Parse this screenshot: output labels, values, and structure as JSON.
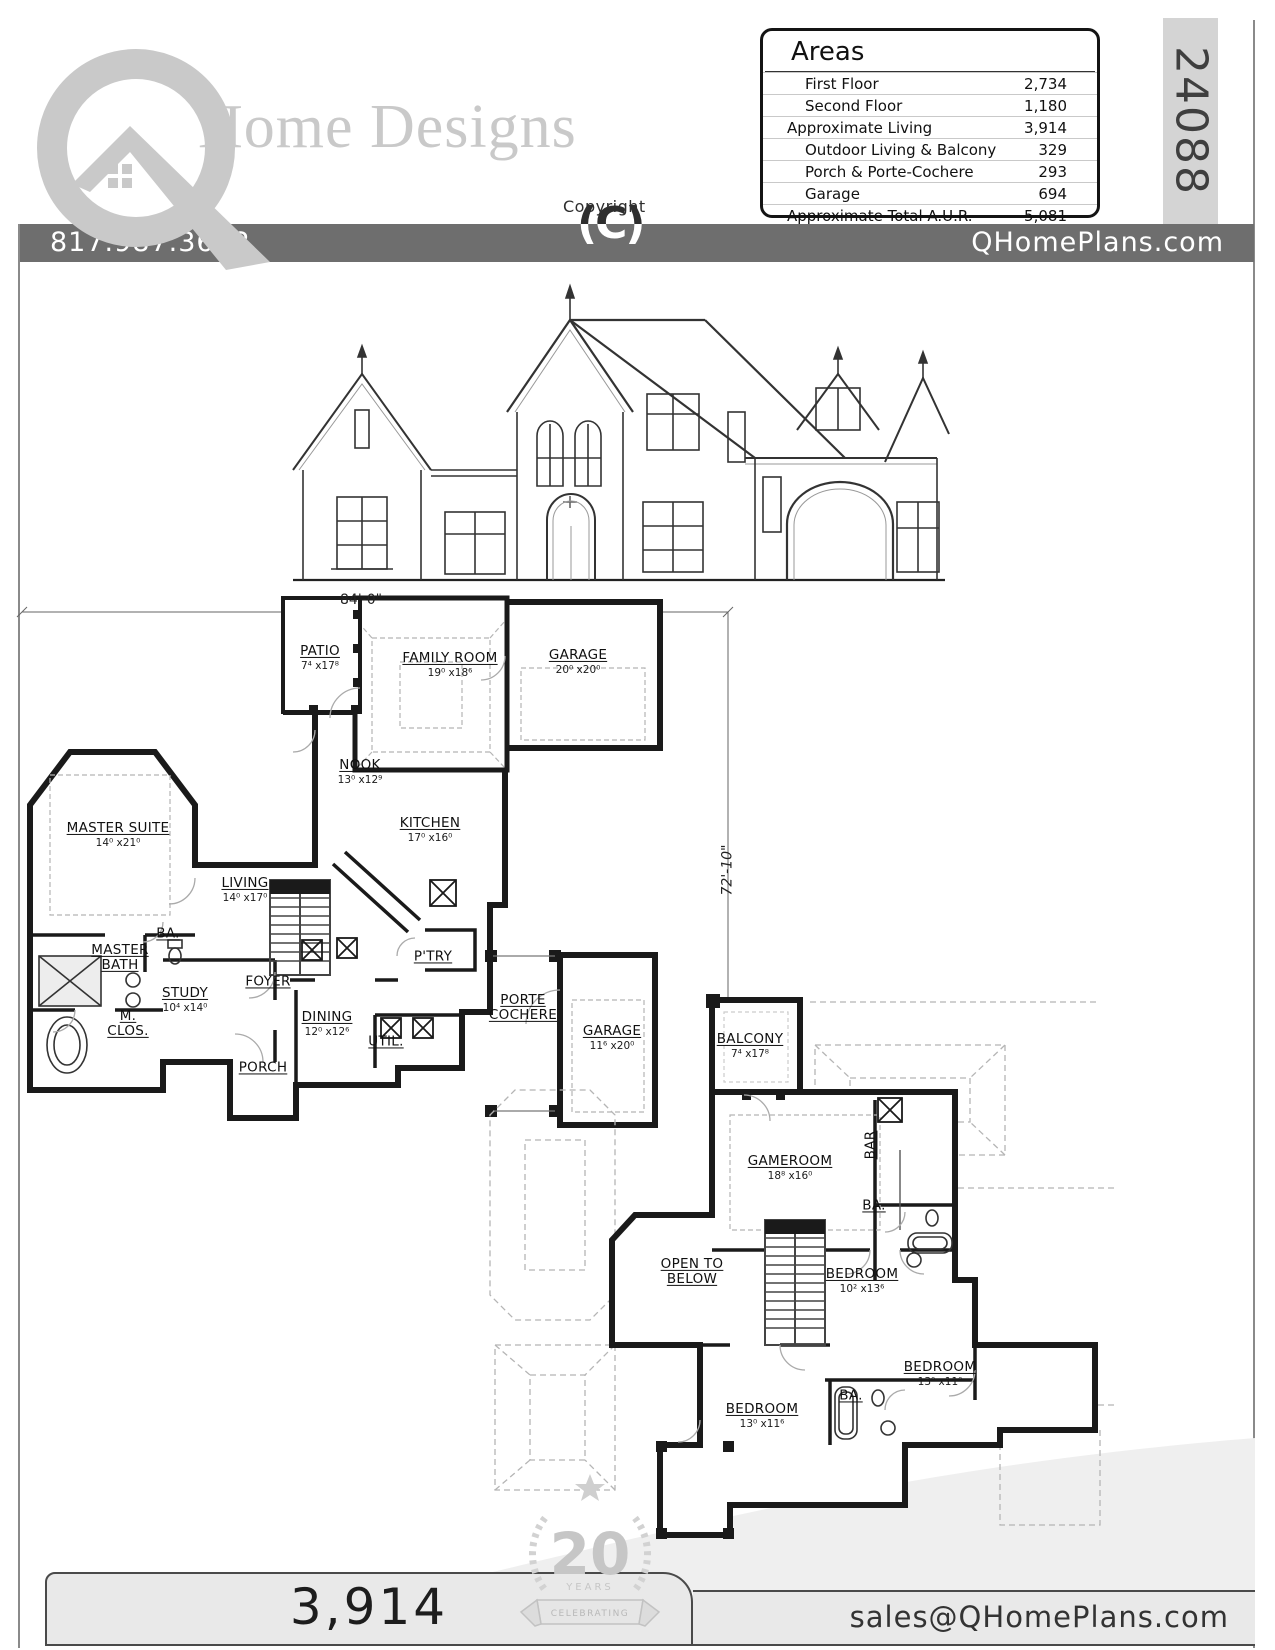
{
  "brand": {
    "logo_text": "Home Designs",
    "phone": "817.987.3622",
    "website": "QHomePlans.com",
    "email": "sales@QHomePlans.com",
    "copyright_label": "Copyright",
    "copyright_mark": "(C)",
    "plan_number": "24088",
    "total_living": "3,914",
    "badge_number": "20",
    "badge_years": "YEARS",
    "badge_banner": "CELEBRATING",
    "accent_gray": "#6e6e6e",
    "logo_gray": "#c9c9c9"
  },
  "areas": {
    "title": "Areas",
    "rows": [
      {
        "label": "First Floor",
        "value": "2,734",
        "indent": 1
      },
      {
        "label": "Second Floor",
        "value": "1,180",
        "indent": 1
      },
      {
        "label": "Approximate Living",
        "value": "3,914",
        "indent": 0
      },
      {
        "label": "Outdoor Living & Balcony",
        "value": "329",
        "indent": 1
      },
      {
        "label": "Porch & Porte-Cochere",
        "value": "293",
        "indent": 1
      },
      {
        "label": "Garage",
        "value": "694",
        "indent": 1
      },
      {
        "label": "Approximate Total A.U.R.",
        "value": "5,081",
        "indent": 0
      }
    ]
  },
  "first_floor": {
    "width_dim": "84'-0\"",
    "height_dim": "72'-10\"",
    "rooms": {
      "patio": {
        "name": "PATIO",
        "dims": "7⁴ x17⁸"
      },
      "family": {
        "name": "FAMILY ROOM",
        "dims": "19⁰ x18⁶"
      },
      "garage": {
        "name": "GARAGE",
        "dims": "20⁰ x20⁰"
      },
      "nook": {
        "name": "NOOK",
        "dims": "13⁰ x12⁹"
      },
      "kitchen": {
        "name": "KITCHEN",
        "dims": "17⁰ x16⁰"
      },
      "master": {
        "name": "MASTER SUITE",
        "dims": "14⁰ x21⁰"
      },
      "living": {
        "name": "LIVING",
        "dims": "14⁰ x17⁰"
      },
      "ba": {
        "name": "BA."
      },
      "master_bath": {
        "l1": "MASTER",
        "l2": "BATH"
      },
      "mclos": {
        "l1": "M.",
        "l2": "CLOS."
      },
      "study": {
        "name": "STUDY",
        "dims": "10⁴ x14⁰"
      },
      "foyer": {
        "name": "FOYER"
      },
      "dining": {
        "name": "DINING",
        "dims": "12⁰ x12⁶"
      },
      "porch": {
        "name": "PORCH"
      },
      "util": {
        "name": "UTIL."
      },
      "ptry": {
        "name": "P'TRY"
      },
      "porte": {
        "l1": "PORTE",
        "l2": "COCHERE"
      },
      "garage2": {
        "name": "GARAGE",
        "dims": "11⁶ x20⁰"
      }
    }
  },
  "second_floor": {
    "rooms": {
      "balcony": {
        "name": "BALCONY",
        "dims": "7⁴ x17⁸"
      },
      "gameroom": {
        "name": "GAMEROOM",
        "dims": "18⁸ x16⁰"
      },
      "bar": {
        "name": "BAR"
      },
      "ba_up": {
        "name": "BA."
      },
      "open_below": {
        "l1": "OPEN TO",
        "l2": "BELOW"
      },
      "bedroom1": {
        "name": "BEDROOM",
        "dims": "10² x13⁶"
      },
      "bedroom2": {
        "name": "BEDROOM",
        "dims": "13⁰ x11⁰"
      },
      "bedroom3": {
        "name": "BEDROOM",
        "dims": "13⁰ x11⁶"
      },
      "ba_low": {
        "name": "BA."
      }
    }
  }
}
